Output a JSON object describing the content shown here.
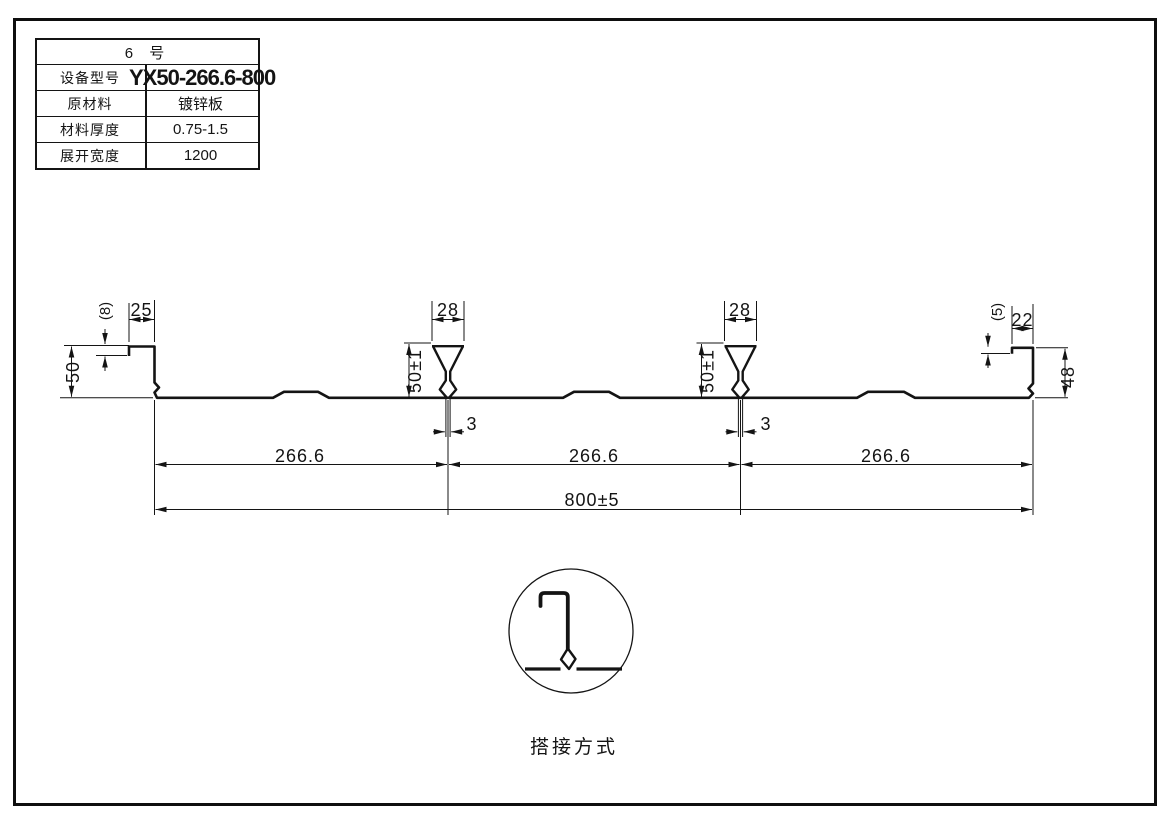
{
  "spec_table": {
    "title": "6 号",
    "rows": [
      {
        "label": "设备型号",
        "value": "YX50-266.6-800"
      },
      {
        "label": "原材料",
        "value": "镀锌板"
      },
      {
        "label": "材料厚度",
        "value": "0.75-1.5"
      },
      {
        "label": "展开宽度",
        "value": "1200"
      }
    ]
  },
  "profile": {
    "dims": {
      "left_lip": "(8)",
      "left_flange": "25",
      "left_height": "50",
      "rib1_width": "28",
      "rib1_height": "50±1",
      "rib1_stem": "3",
      "rib2_width": "28",
      "rib2_height": "50±1",
      "rib2_stem": "3",
      "right_lip": "(5)",
      "right_flange": "22",
      "right_height": "48",
      "span1": "266.6",
      "span2": "266.6",
      "span3": "266.6",
      "overall": "800±5"
    }
  },
  "detail": {
    "caption": "搭接方式"
  },
  "colors": {
    "line": "#141414",
    "background": "#ffffff"
  }
}
